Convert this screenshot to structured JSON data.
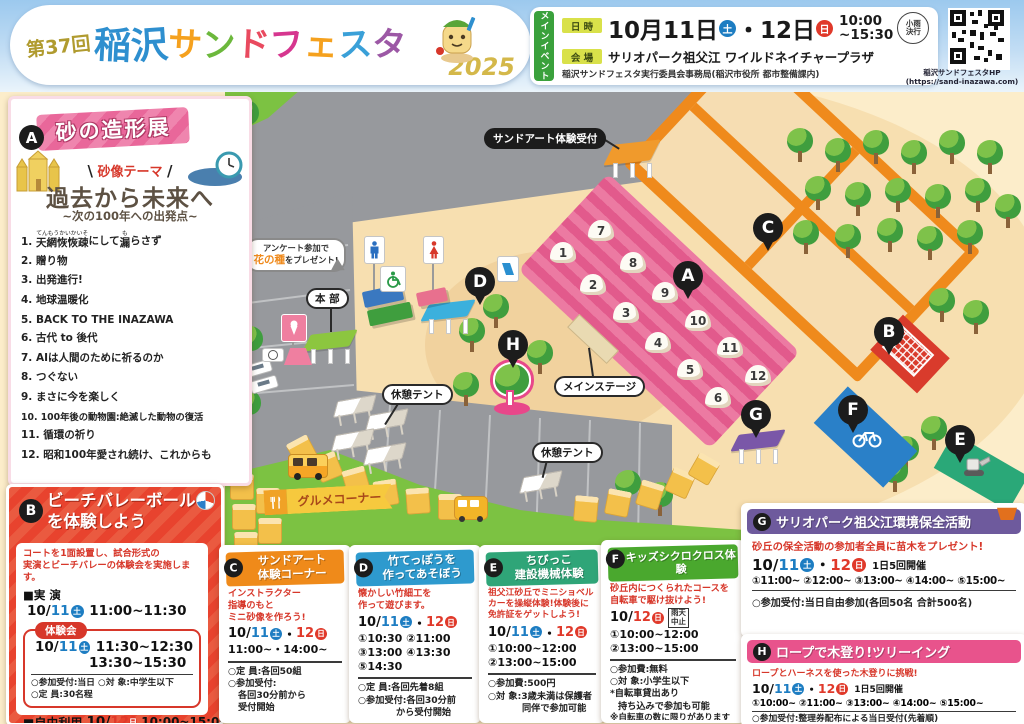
{
  "colors": {
    "sat_blue": "#1d7dc2",
    "sun_red": "#e0392a",
    "banner_pink": "#e9679a",
    "header_green": "#3aa13c",
    "panel_c_orange": "#ef8a1a",
    "panel_d_blue": "#2e9ace",
    "panel_e_green": "#2fa578",
    "panel_f_green": "#4aa82e",
    "panel_g_purple": "#6e5a9d",
    "panel_h_pink": "#e8538c",
    "map_sand": "#f7dfb0",
    "grass": "#7cc242",
    "road": "#97999d"
  },
  "header": {
    "edition": "第37回",
    "t1": "稲",
    "t2": "沢",
    "t3": "サ",
    "t4": "ン",
    "t5": "ド",
    "t6": "フ",
    "t7": "ェ",
    "t8": "ス",
    "t9": "タ",
    "year": "2025",
    "main_event": "メインイベント",
    "datetime_label": "日 時",
    "date_m": "10月",
    "date_d1": "11日",
    "sat": "土",
    "sep": "・",
    "date_d2": "12日",
    "sun": "日",
    "time1": "10:00",
    "time2": "~15:30",
    "rain1": "小雨",
    "rain2": "決行",
    "venue_label": "会 場",
    "venue": "サリオパーク祖父江 ワイルドネイチャープラザ",
    "organizer": "稲沢サンドフェスタ実行委員会事務局(稲沢市役所 都市整備課内)",
    "hp_label": "稲沢サンドフェスタHP",
    "hp_url": "(https://sand-inazawa.com)"
  },
  "dates": {
    "m": "10/",
    "d11": "11",
    "sat": "土",
    "sep": "・",
    "d12": "12",
    "sun": "日"
  },
  "panel_a": {
    "badge": "A",
    "title": "砂の造形展",
    "slash_l": "\\",
    "slash_r": "/",
    "theme_label": "砂像テーマ",
    "theme_title": "過去から未来へ",
    "theme_sub": "~次の100年への出発点~",
    "item1": {
      "num": "1.",
      "ruby1": "てんもうかいかいそ",
      "base1": "天網恢恢疎",
      "mid": "にして",
      "ruby2": "も",
      "base2": "漏",
      "tail": "らさず"
    },
    "items": [
      "2. 贈り物",
      "3. 出発進行!",
      "4. 地球温暖化",
      "5. BACK TO THE INAZAWA",
      "6. 古代 to 後代",
      "7. AIは人間のために祈るのか",
      "8. つぐない",
      "9. まさに今を楽しく",
      "10. 100年後の動物園:絶滅した動物の復活",
      "11. 循環の祈り",
      "12. 昭和100年愛され続け、これからも"
    ]
  },
  "map": {
    "reception_label": "サンドアート体験受付",
    "survey1": "アンケート参加で",
    "survey2": "花の種",
    "survey3": "をプレゼント!",
    "honbu": "本 部",
    "rest_tent": "休憩テント",
    "main_stage": "メインステージ",
    "gourmet": "グルメコーナー",
    "numbers": [
      "1",
      "2",
      "3",
      "4",
      "5",
      "6",
      "7",
      "8",
      "9",
      "10",
      "11",
      "12"
    ],
    "markers": [
      "A",
      "B",
      "C",
      "D",
      "E",
      "F",
      "G",
      "H"
    ]
  },
  "panel_b": {
    "badge": "B",
    "title1": "ビーチバレーボール",
    "title2": "を体験しよう",
    "desc1": "コートを1面設置し、試合形式の",
    "desc2": "実演とビーチバレーの体験会を実施します。",
    "demo_label": "■実 演",
    "demo_time": "11:00~11:30",
    "trial_badge": "体験会",
    "trial_time1": "11:30~12:30",
    "trial_time2": "13:30~15:30",
    "note1": "○参加受付:当日 ○対 象:中学生以下",
    "note2": "○定 員:30名程",
    "free_label": "■自由利用",
    "free_time": "10:00~15:00"
  },
  "panel_c": {
    "badge": "C",
    "title1": "サンドアート",
    "title2": "体験コーナー",
    "desc1": "インストラクター",
    "desc2": "指導のもと",
    "desc3": "ミニ砂像を作ろう!",
    "times": "11:00~・14:00~",
    "note1": "○定 員:各回50組",
    "note2": "○参加受付:",
    "note3": "各回30分前から",
    "note4": "受付開始"
  },
  "panel_d": {
    "badge": "D",
    "title1": "竹てっぽうを",
    "title2": "作ってあそぼう",
    "desc1": "懐かしい竹細工を",
    "desc2": "作って遊びます。",
    "times1": "①10:30 ②11:00",
    "times2": "③13:00 ④13:30",
    "times3": "⑤14:30",
    "note1": "○定 員:各回先着8組",
    "note2": "○参加受付:各回30分前",
    "note3": "から受付開始"
  },
  "panel_e": {
    "badge": "E",
    "title1": "ちびっこ",
    "title2": "建設機械体験",
    "desc1": "祖父江砂丘でミニショベル",
    "desc2": "カーを操縦体験!体験後に",
    "desc3": "免許証をゲットしよう!",
    "times1": "①10:00~12:00",
    "times2": "②13:00~15:00",
    "note1": "○参加費:500円",
    "note2": "○対 象:3歳未満は保護者",
    "note3": "同伴で参加可能"
  },
  "panel_f": {
    "badge": "F",
    "title": "キッズシクロクロス体験",
    "desc1": "砂丘内につくられたコースを",
    "desc2": "自転車で駆け抜けよう!",
    "rain1": "雨天",
    "rain2": "中止",
    "times1": "①10:00~12:00",
    "times2": "②13:00~15:00",
    "note1": "○参加費:無料",
    "note2": "○対 象:小学生以下",
    "note3": "*自転車貸出あり",
    "note4": "持ち込みで参加も可能",
    "note5": "※自転車の数に限りがあります"
  },
  "panel_g": {
    "badge": "G",
    "title": "サリオパーク祖父江環境保全活動",
    "desc": "砂丘の保全活動の参加者全員に苗木をプレゼント!",
    "freq": "1日5回開催",
    "times": "①11:00~ ②12:00~ ③13:00~ ④14:00~ ⑤15:00~",
    "note": "○参加受付:当日自由参加(各回50名 合計500名)"
  },
  "panel_h": {
    "badge": "H",
    "title": "ロープで木登り!ツリーイング",
    "desc": "ロープとハーネスを使った木登りに挑戦!",
    "freq": "1日5回開催",
    "times": "①10:00~ ②11:00~ ③13:00~ ④14:00~ ⑤15:00~",
    "note1": "○参加受付:整理券配布による当日受付(先着順)",
    "note2": "①②は9:30~ ③④⑤は12:30~",
    "note3": "○参加費:1,500円 ○対 象:小学生以上"
  }
}
